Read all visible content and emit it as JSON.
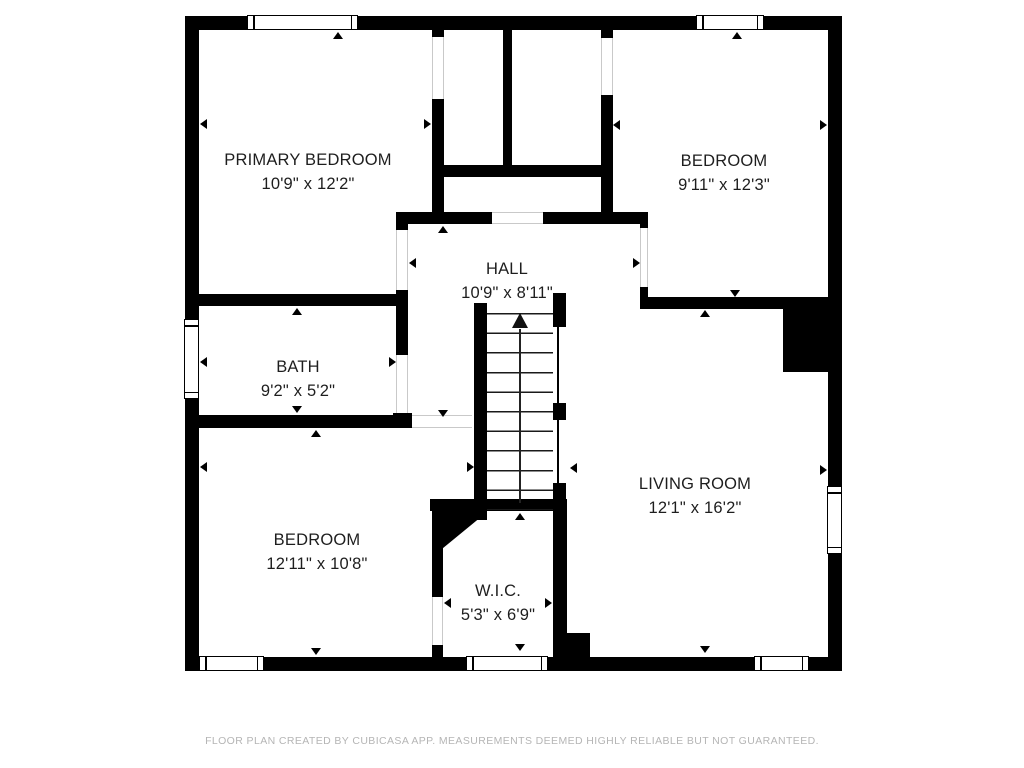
{
  "floorplan": {
    "title": "Upper floor plan",
    "rooms": {
      "primary_bedroom": {
        "name": "PRIMARY BEDROOM",
        "size": "10'9\" x 12'2\""
      },
      "bedroom_top": {
        "name": "BEDROOM",
        "size": "9'11\" x 12'3\""
      },
      "hall": {
        "name": "HALL",
        "size": "10'9\" x 8'11\""
      },
      "bath": {
        "name": "BATH",
        "size": "9'2\" x 5'2\""
      },
      "bedroom_bottom": {
        "name": "BEDROOM",
        "size": "12'11\" x 10'8\""
      },
      "wic": {
        "name": "W.I.C.",
        "size": "5'3\" x 6'9\""
      },
      "living_room": {
        "name": "LIVING ROOM",
        "size": "12'1\" x 16'2\""
      }
    },
    "stairs": {
      "direction": "up-arrow",
      "steps": 10
    },
    "footer": "FLOOR PLAN CREATED BY CUBICASA APP. MEASUREMENTS DEEMED HIGHLY RELIABLE BUT NOT GUARANTEED.",
    "colors": {
      "wall": "#000000",
      "background": "#ffffff",
      "label_text": "#1e1e1e",
      "footer_text": "#b5b5b5"
    }
  }
}
